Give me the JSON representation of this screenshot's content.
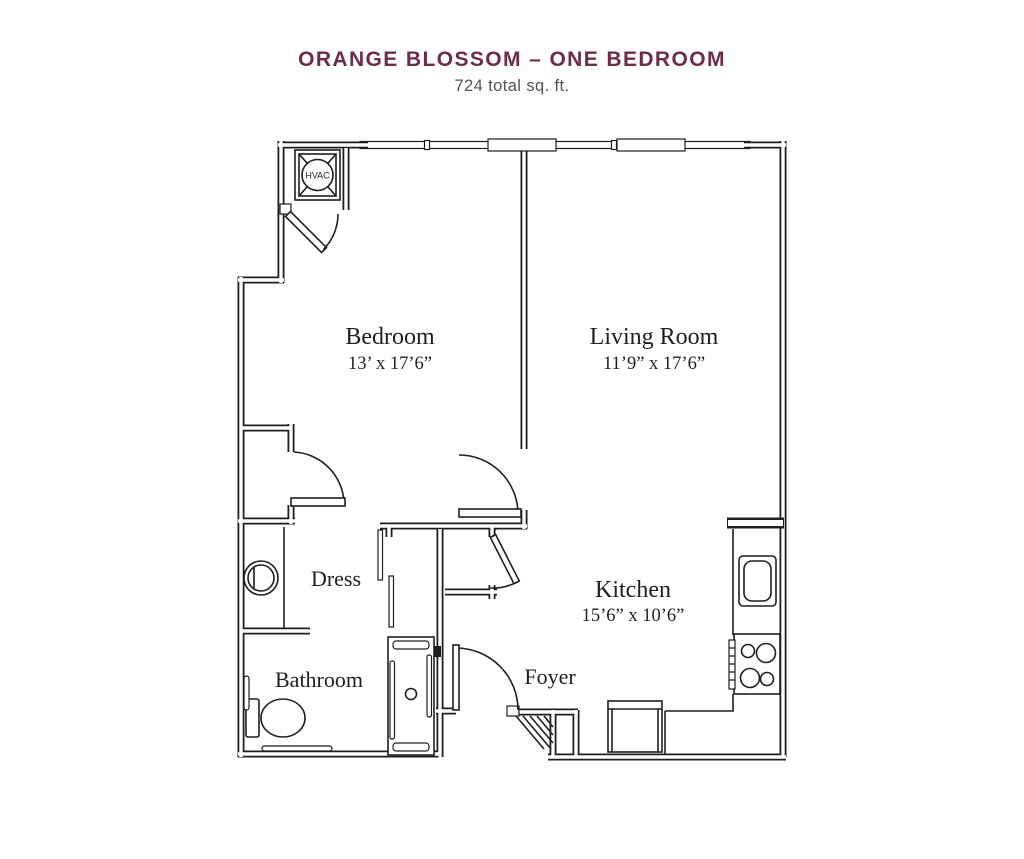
{
  "header": {
    "title": "ORANGE BLOSSOM – ONE BEDROOM",
    "subtitle": "724 total sq. ft."
  },
  "rooms": {
    "bedroom": {
      "name": "Bedroom",
      "dims": "13’ x 17’6”"
    },
    "living_room": {
      "name": "Living Room",
      "dims": "11’9” x 17’6”"
    },
    "kitchen": {
      "name": "Kitchen",
      "dims": "15’6” x 10’6”"
    },
    "dress": {
      "name": "Dress"
    },
    "bathroom": {
      "name": "Bathroom"
    },
    "foyer": {
      "name": "Foyer"
    },
    "hvac": {
      "label": "HVAC"
    }
  },
  "colors": {
    "title": "#6b2d4b",
    "subtitle": "#4e555b",
    "line": "#1f1f1f"
  }
}
